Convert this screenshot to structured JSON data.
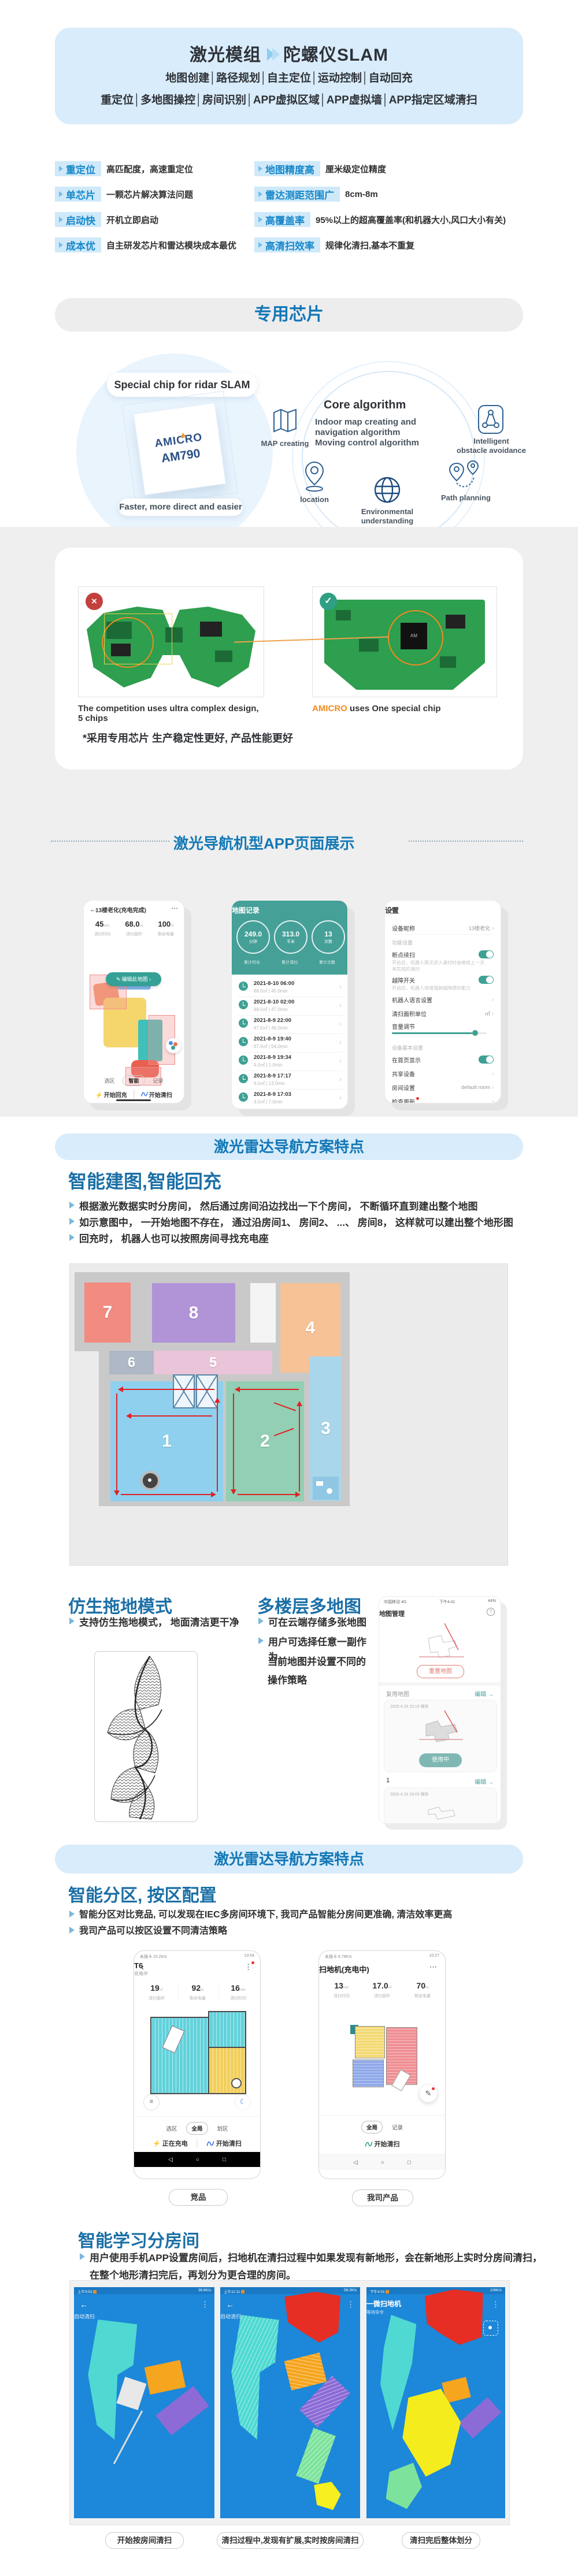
{
  "hero": {
    "title_left": "激光模组",
    "title_right": "陀螺仪SLAM",
    "line1": "地图创建│路径规划│自主定位│运动控制│自动回充",
    "line2": "重定位│多地图操控│房间识别│APP虚拟区域│APP虚拟墙│APP指定区域清扫"
  },
  "features": {
    "left": [
      {
        "tag": "重定位",
        "desc": "高匹配度，高速重定位"
      },
      {
        "tag": "单芯片",
        "desc": "一颗芯片解决算法问题"
      },
      {
        "tag": "启动快",
        "desc": "开机立即启动"
      },
      {
        "tag": "成本优",
        "desc": "自主研发芯片和雷达模块成本最优"
      }
    ],
    "right": [
      {
        "tag": "地图精度高",
        "desc": "厘米级定位精度"
      },
      {
        "tag": "雷达测距范围广",
        "desc": "8cm-8m"
      },
      {
        "tag": "高覆盖率",
        "desc": "95%以上的超高覆盖率(和机器大小,风口大小有关)"
      },
      {
        "tag": "高清扫效率",
        "desc": "规律化清扫,基本不重复"
      }
    ]
  },
  "chip": {
    "banner": "专用芯片",
    "special_label": "Special chip for ridar SLAM",
    "brand": "AMICRO",
    "model": "AM790",
    "caption": "Faster, more direct and easier",
    "core_title": "Core algorithm",
    "core_line1": "Indoor map creating and",
    "core_line2": "navigation algorithm",
    "core_line3": "Moving control algorithm",
    "node_map": "MAP creating",
    "node_location": "location",
    "node_env1": "Environmental",
    "node_env2": "understanding",
    "node_path": "Path planning",
    "node_obs1": "Intelligent",
    "node_obs2": "obstacle avoidance"
  },
  "pcb": {
    "left_caption": "The competition uses ultra complex design, 5 chips",
    "brand": "AMICRO",
    "right_caption": " uses One special chip",
    "note": "*采用专用芯片 生产稳定性更好, 产品性能更好"
  },
  "app": {
    "title": "激光导航机型APP页面展示",
    "phone1": {
      "title": "13楼老化(充电完成)",
      "stats": [
        {
          "v": "45",
          "u": "min",
          "l": "清扫时间"
        },
        {
          "v": "68.0",
          "u": "㎡",
          "l": "清扫面积"
        },
        {
          "v": "100",
          "u": "%",
          "l": "剩余电量"
        }
      ],
      "edit": "编辑此地图 ›",
      "tabs": [
        "选区",
        "智能",
        "记录"
      ],
      "recharge": "开始回充",
      "clean": "开始清扫"
    },
    "phone2": {
      "title": "地图记录",
      "circles": [
        {
          "v": "249.0",
          "u": "分钟"
        },
        {
          "v": "313.0",
          "u": "平米"
        },
        {
          "v": "13",
          "u": "次数"
        }
      ],
      "labels": [
        "累计时长",
        "累计清扫",
        "累计次数"
      ],
      "records": [
        {
          "t": "2021-8-10 06:00",
          "s": "68.0㎡ | 45.0min"
        },
        {
          "t": "2021-8-10 02:00",
          "s": "68.0㎡ | 47.0min"
        },
        {
          "t": "2021-8-9 22:00",
          "s": "67.0㎡ | 46.0min"
        },
        {
          "t": "2021-8-9 19:40",
          "s": "67.0㎡ | 54.0min"
        },
        {
          "t": "2021-8-9 19:34",
          "s": "4.0㎡ | 1.0min"
        },
        {
          "t": "2021-8-9 17:17",
          "s": "6.0㎡ | 13.0min"
        },
        {
          "t": "2021-8-9 17:03",
          "s": "3.0㎡ | 7.0min"
        }
      ]
    },
    "phone3": {
      "title": "设置",
      "nickname": "设备昵称",
      "nickname_v": "13楼老化",
      "sec1": "功能设置",
      "resume": "断点续扫",
      "resume_d1": "开启后，机器人再次进入清扫时会继续上一次",
      "resume_d2": "未完成的清扫",
      "obstacle": "越障开关",
      "obstacle_d": "开启后，机器人将增强跨越障碍的能力",
      "lang": "机器人语言设置",
      "unit": "清扫面积单位",
      "unit_v": "㎡",
      "volume": "音量调节",
      "sec2": "设备基本设置",
      "home": "在首页显示",
      "share": "共享设备",
      "room": "房间设置",
      "room_v": "default room",
      "update": "检查更新"
    }
  },
  "lidar1": {
    "banner": "激光雷达导航方案特点",
    "title": "智能建图,智能回充",
    "b1": "根据激光数据实时分房间， 然后通过房间沿边找出一下个房间， 不断循环直到建出整个地图",
    "b2": "如示意图中， 一开始地图不存在， 通过沿房间1、 房间2、 ...、 房间8， 这样就可以建出整个地形图",
    "b3": "回充时， 机器人也可以按照房间寻找充电座"
  },
  "plan": {
    "rooms": [
      "1",
      "2",
      "3",
      "4",
      "5",
      "6",
      "7",
      "8"
    ]
  },
  "mop": {
    "title": "仿生拖地模式",
    "b1": "支持仿生拖地模式， 地面清洁更干净"
  },
  "multimap": {
    "title": "多楼层多地图",
    "b1": "可在云端存储多张地图",
    "b2l1": "用户可选择任意一副作为",
    "b2l2": "当前地图并设置不同的",
    "b2l3": "操作策略",
    "phone": {
      "carrier": "中国移动 4G",
      "time": "下午4:41",
      "battery": "44%",
      "title": "地图管理",
      "reset": "重置地图",
      "reuse": "复用地图",
      "edit": "编辑 →",
      "card1_date": "2020.4.15 15:13 保存",
      "inuse": "使用中",
      "index1": "1",
      "edit2": "编辑 →",
      "card2_date": "2020.4.15 16:03 保存"
    }
  },
  "lidar2": {
    "banner": "激光雷达导航方案特点",
    "title": "智能分区, 按区配置",
    "b1": "智能分区对比竞品, 可以发现在IEC多房间环境下, 我司产品智能分房间更准确, 清洁效率更高",
    "b2": "我司产品可以按区设置不同清洁策略"
  },
  "cmp": {
    "left": {
      "status_l": "未插卡 15.2K/s",
      "time": "10:54",
      "title": "T6",
      "subtitle": "充电中",
      "stats": [
        {
          "v": "19",
          "u": "㎡",
          "l": "清扫面积"
        },
        {
          "v": "92",
          "u": "%",
          "l": "剩余电量"
        },
        {
          "v": "16",
          "u": "min",
          "l": "清扫时间"
        }
      ],
      "tabs": [
        "选区",
        "全局",
        "划区"
      ],
      "charging": "正在充电",
      "clean": "开始清扫",
      "label": "竞品"
    },
    "right": {
      "status_l": "未插卡 6.78K/s",
      "time": "10:27",
      "title": "扫地机(充电中)",
      "stats": [
        {
          "v": "13",
          "u": "min",
          "l": "清扫时间"
        },
        {
          "v": "17.0",
          "u": "㎡",
          "l": "清扫面积"
        },
        {
          "v": "70",
          "u": "%",
          "l": "剩余电量"
        }
      ],
      "tabs": [
        "全局",
        "记录"
      ],
      "clean": "开始清扫",
      "label": "我司产品"
    }
  },
  "learning": {
    "title": "智能学习分房间",
    "b1l1": "用户使用手机APP设置房间后，扫地机在清扫过程中如果发现有新地形，会在新地形上实时分房间清扫，",
    "b1l2": "在整个地形清扫完后，再划分为更合理的房间。",
    "phones": [
      {
        "time": "上午9:52",
        "speed": "36.6K/s",
        "title": "自动清扫",
        "caption": "开始按房间清扫"
      },
      {
        "time": "上午11:11",
        "speed": "58.2K/s",
        "title": "自动清扫",
        "caption": "清扫过程中,发现有扩展,实时按房间清扫"
      },
      {
        "time": "下午4:01",
        "speed": "106K/s",
        "title": "一微扫地机",
        "subtitle": "等待命令",
        "caption": "清扫完后整体划分"
      }
    ]
  },
  "colors": {
    "accent_blue": "#1377b5",
    "banner_bg": "#d8ecfb",
    "teal": "#45a098",
    "tag_bg": "#cfe9f9",
    "tag_text": "#1787c9",
    "pcb_orange": "#f08c1e"
  }
}
